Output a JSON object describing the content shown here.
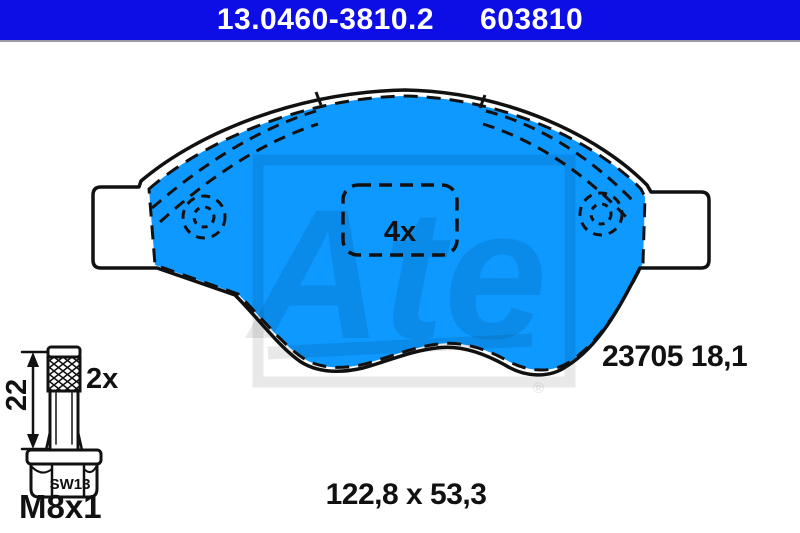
{
  "header": {
    "part_number": "13.0460-3810.2",
    "article_code": "603810"
  },
  "pad": {
    "quantity_label": "4x",
    "wva_thickness_label": "23705 18,1",
    "dimensions_label": "122,8 x 53,3"
  },
  "bolt": {
    "quantity_label": "2x",
    "length_label": "22",
    "wrench_size_label": "SW13",
    "thread_label": "M8x1"
  },
  "watermark": {
    "brand": "Ate",
    "registered_mark": "®"
  },
  "colors": {
    "header_bg": "#0D0DE6",
    "pad_fill": "#0D99FF",
    "line": "#111111",
    "watermark": "rgba(0,0,0,0.085)"
  }
}
